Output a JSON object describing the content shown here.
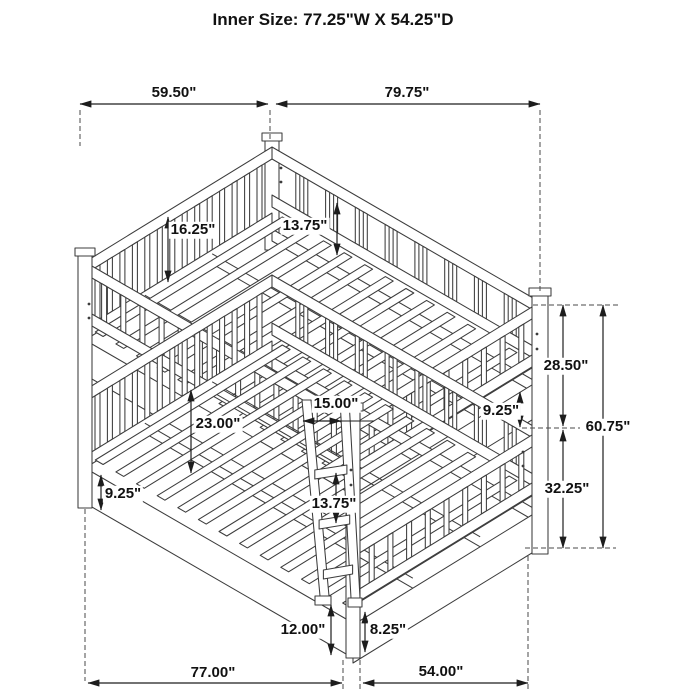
{
  "title": "Inner Size: 77.25\"W X 54.25\"D",
  "drawing_type": "isometric-bunk-bed-dimension-diagram",
  "colors": {
    "line": "#3c3c3c",
    "dimension_line": "#1d1d1d",
    "text": "#111111",
    "background": "#ffffff"
  },
  "dimensions": {
    "top_depth": "59.50\"",
    "top_width": "79.75\"",
    "headboard_panel_height": "16.25\"",
    "guardrail_to_deck": "13.75\"",
    "upper_bunk_section_height": "28.50\"",
    "overall_height": "60.75\"",
    "lower_bunk_section_height": "32.25\"",
    "footboard_rail_height": "9.25\"",
    "ladder_width": "15.00\"",
    "bunk_clearance": "23.00\"",
    "ladder_rung_spacing": "13.75\"",
    "side_rail_height": "9.25\"",
    "ladder_ground_clearance": "12.00\"",
    "rail_ground_clearance": "8.25\"",
    "floor_width": "77.00\"",
    "floor_depth": "54.00\""
  }
}
